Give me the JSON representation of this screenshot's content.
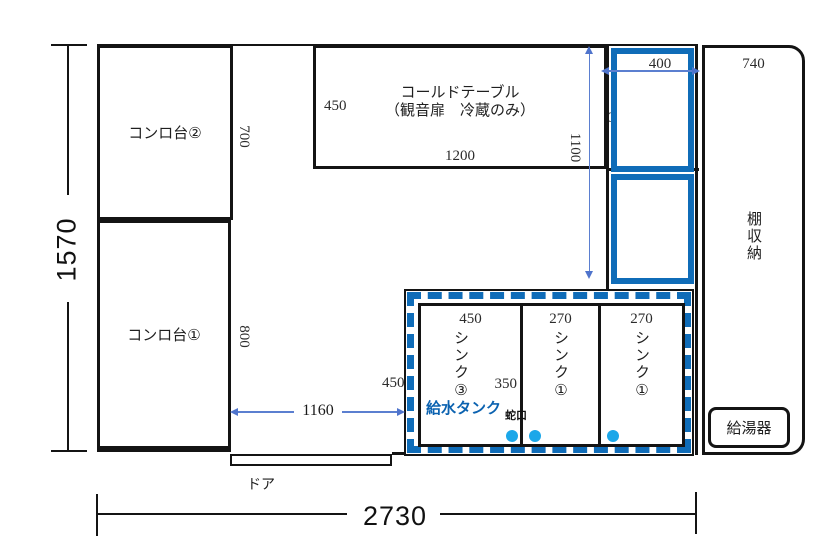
{
  "colors": {
    "tank_blue": "#0f6cb8",
    "faucet_light_blue": "#1ba7e9",
    "drain_orange": "#f0821e",
    "dimension_arrow_blue": "#4f74cc",
    "line_black": "#141414"
  },
  "overall_dims": {
    "height": "1570",
    "width": "2730"
  },
  "konro2": {
    "label": "コンロ台②",
    "depth": "700"
  },
  "konro1": {
    "label": "コンロ台①",
    "depth": "800"
  },
  "cold_table": {
    "label": "コールドテーブル",
    "sub_label": "（観音扉　冷蔵のみ）",
    "depth": "450",
    "width": "1200"
  },
  "drain_tank": {
    "label": "排水タンク",
    "height_label": "H250",
    "width": "400",
    "column_height": "1100"
  },
  "shelf": {
    "label": "棚収納",
    "width": "740"
  },
  "water_heater": {
    "label": "給湯器"
  },
  "door": {
    "label": "ドア"
  },
  "sink_area": {
    "gap_from_konro": "1160",
    "left_depth": "450",
    "water_tank_label": "給水タンク",
    "faucet_label": "蛇口",
    "sinks": [
      {
        "width": "450",
        "label": "シンク③",
        "inner_dim": "350"
      },
      {
        "width": "270",
        "label": "シンク①"
      },
      {
        "width": "270",
        "label": "シンク①"
      }
    ]
  }
}
